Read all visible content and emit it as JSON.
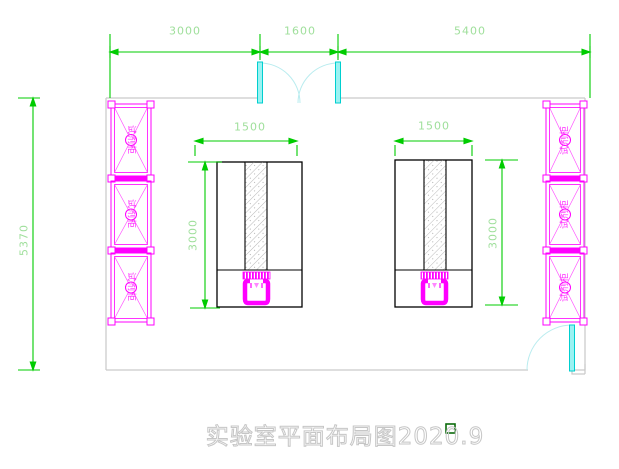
{
  "title_block": {
    "text": "实验室平面布局图2020.9"
  },
  "dimensions": {
    "top_left_span": "3000",
    "top_door_span": "1600",
    "top_right_span": "5400",
    "left_wall_height": "5370",
    "left_bench_width": "1500",
    "left_bench_depth": "3000",
    "right_bench_width": "1500",
    "right_bench_depth": "3000"
  },
  "labels": {
    "reagent_cabinet": "试剂柜"
  },
  "colors": {
    "dimension_line": "#00cc00",
    "dimension_text": "#9fdf9b",
    "cabinet": "#ff00ff",
    "door_leaf": "#2ee0e0",
    "door_arc": "#b9ecef",
    "wall": "#c9c9c9",
    "bench_outline": "#000000",
    "title_outline": "#c6c6c6"
  }
}
